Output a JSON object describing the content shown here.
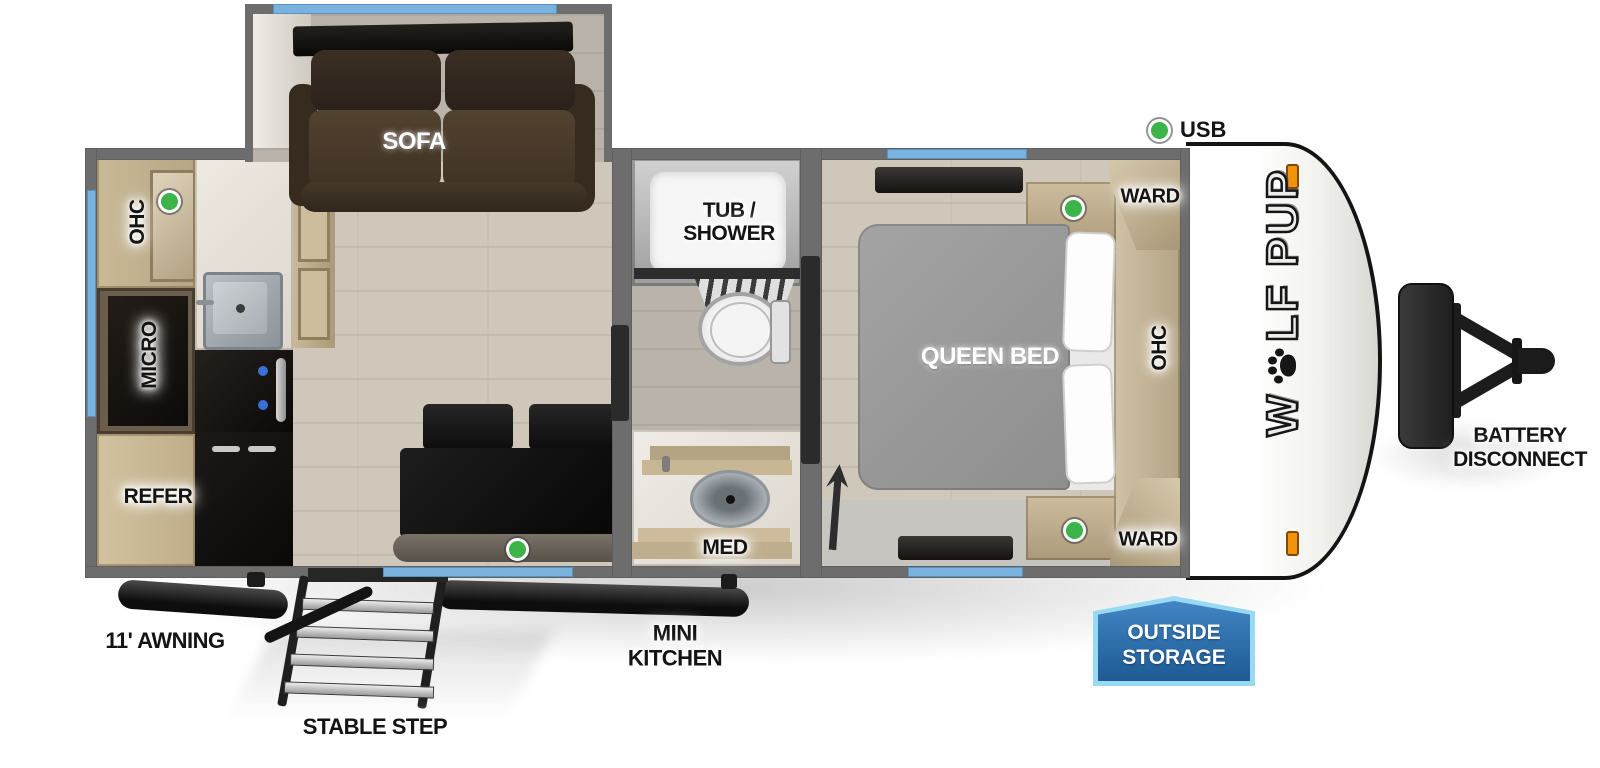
{
  "title": "Wolf Pup travel trailer floorplan",
  "colors": {
    "wall": "#6d6d6d",
    "window_blue": "#7ab2df",
    "indicator_green": "#3cb44a",
    "clearance_orange": "#f0930a",
    "badge_blue": "#3579b7",
    "badge_border": "#9ad9f2"
  },
  "rooms": {
    "sofa": "SOFA",
    "queen_bed": "QUEEN BED",
    "ward_top": "WARD",
    "ward_bottom": "WARD",
    "ohc_bedroom": "OHC",
    "ohc_kitchen": "OHC",
    "micro": "MICRO",
    "refer": "REFER",
    "tub_shower_line1": "TUB /",
    "tub_shower_line2": "SHOWER",
    "med": "MED"
  },
  "callouts": {
    "usb": "USB",
    "battery_line1": "BATTERY",
    "battery_line2": "DISCONNECT",
    "awning": "11' AWNING",
    "stable_step": "STABLE STEP",
    "mini_kitchen_line1": "MINI",
    "mini_kitchen_line2": "KITCHEN",
    "outside_storage_line1": "OUTSIDE",
    "outside_storage_line2": "STORAGE"
  },
  "logo": {
    "prefix": "W",
    "suffix": "LF PUP"
  }
}
